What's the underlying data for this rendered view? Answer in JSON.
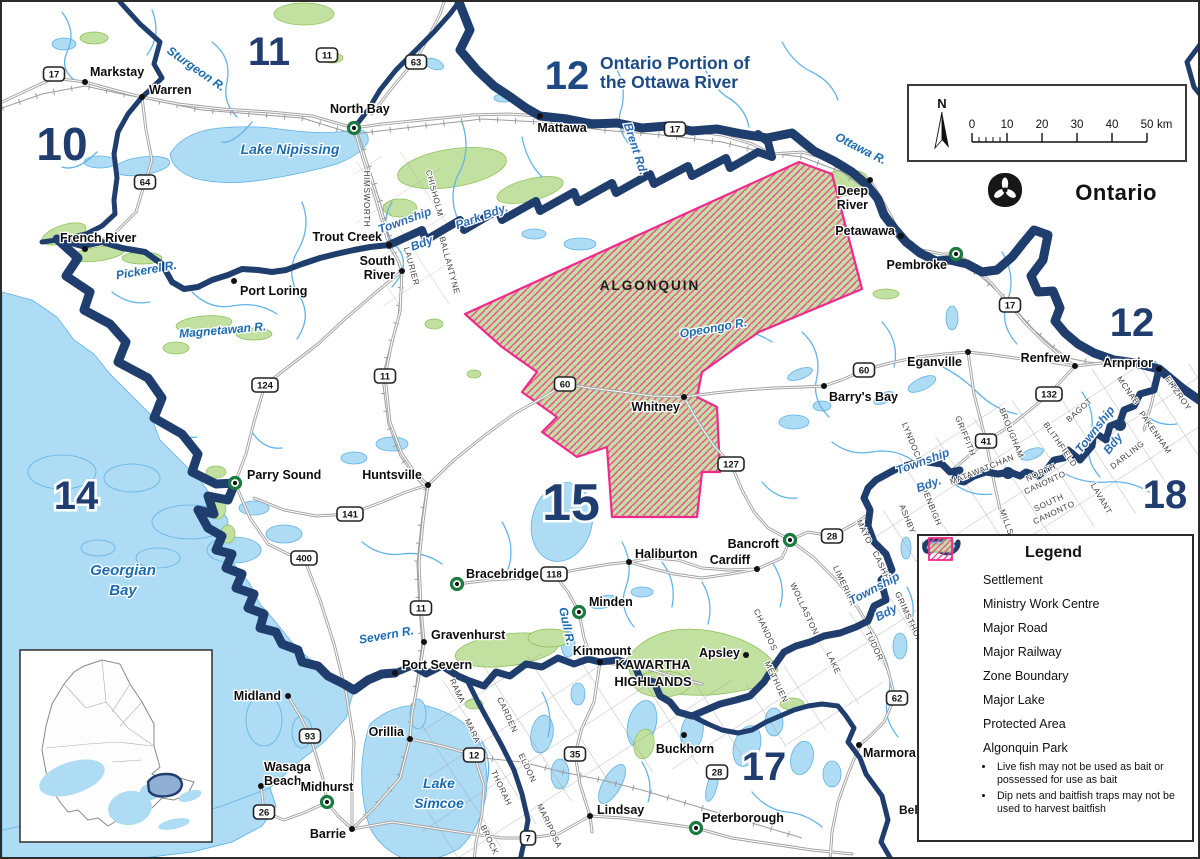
{
  "title": {
    "zone": "12",
    "line1": "Ontario Portion of",
    "line2": "the Ottawa River"
  },
  "logo": {
    "name": "Ontario"
  },
  "scalebar": {
    "north": "N",
    "ticks": [
      "0",
      "10",
      "20",
      "30",
      "40",
      "50"
    ],
    "unit": "km"
  },
  "park_label": {
    "text": "ALGONQUIN",
    "x": 648,
    "y": 288
  },
  "area_labels": [
    {
      "t": "KAWARTHA",
      "x": 651,
      "y": 667,
      "s": 13
    },
    {
      "t": "HIGHLANDS",
      "x": 651,
      "y": 684,
      "s": 13
    },
    {
      "t": "Bell",
      "x": 897,
      "y": 812,
      "s": 12
    }
  ],
  "zones": [
    {
      "t": "10",
      "x": 60,
      "y": 158,
      "s": 46
    },
    {
      "t": "11",
      "x": 267,
      "y": 63,
      "s": 40
    },
    {
      "t": "12",
      "x": 1130,
      "y": 334,
      "s": 40
    },
    {
      "t": "14",
      "x": 74,
      "y": 507,
      "s": 40
    },
    {
      "t": "15",
      "x": 569,
      "y": 518,
      "s": 52
    },
    {
      "t": "17",
      "x": 762,
      "y": 778,
      "s": 40
    },
    {
      "t": "18",
      "x": 1163,
      "y": 506,
      "s": 40
    }
  ],
  "settlements": [
    {
      "n": "Markstay",
      "t": "d",
      "x": 83,
      "y": 80,
      "l": [
        {
          "t": "Markstay",
          "x": 88,
          "y": 74,
          "a": "s"
        }
      ]
    },
    {
      "n": "Warren",
      "t": "d",
      "x": 140,
      "y": 95,
      "l": [
        {
          "t": "Warren",
          "x": 147,
          "y": 92,
          "a": "s"
        }
      ]
    },
    {
      "n": "North Bay",
      "t": "m",
      "x": 352,
      "y": 126,
      "l": [
        {
          "t": "North Bay",
          "x": 328,
          "y": 111,
          "a": "s"
        }
      ]
    },
    {
      "n": "Mattawa",
      "t": "d",
      "x": 538,
      "y": 114,
      "l": [
        {
          "t": "Mattawa",
          "x": 560,
          "y": 130,
          "a": "m"
        }
      ]
    },
    {
      "n": "Trout Creek",
      "t": "d",
      "x": 387,
      "y": 243,
      "l": [
        {
          "t": "Trout Creek",
          "x": 380,
          "y": 239,
          "a": "e"
        }
      ]
    },
    {
      "n": "South River",
      "t": "d",
      "x": 400,
      "y": 269,
      "l": [
        {
          "t": "South",
          "x": 393,
          "y": 263,
          "a": "e"
        },
        {
          "t": "River",
          "x": 393,
          "y": 277,
          "a": "e"
        }
      ]
    },
    {
      "n": "French River",
      "t": "d",
      "x": 83,
      "y": 247,
      "l": [
        {
          "t": "French River",
          "x": 58,
          "y": 240,
          "a": "s"
        }
      ]
    },
    {
      "n": "Port Loring",
      "t": "d",
      "x": 232,
      "y": 279,
      "l": [
        {
          "t": "Port Loring",
          "x": 238,
          "y": 293,
          "a": "s"
        }
      ]
    },
    {
      "n": "Parry Sound",
      "t": "m",
      "x": 233,
      "y": 481,
      "l": [
        {
          "t": "Parry Sound",
          "x": 245,
          "y": 477,
          "a": "s"
        }
      ]
    },
    {
      "n": "Huntsville",
      "t": "d",
      "x": 426,
      "y": 483,
      "l": [
        {
          "t": "Huntsville",
          "x": 420,
          "y": 477,
          "a": "e"
        }
      ]
    },
    {
      "n": "Deep River",
      "t": "d",
      "x": 868,
      "y": 178,
      "l": [
        {
          "t": "Deep",
          "x": 866,
          "y": 193,
          "a": "e"
        },
        {
          "t": "River",
          "x": 866,
          "y": 207,
          "a": "e"
        }
      ]
    },
    {
      "n": "Petawawa",
      "t": "d",
      "x": 899,
      "y": 234,
      "l": [
        {
          "t": "Petawawa",
          "x": 893,
          "y": 233,
          "a": "e"
        }
      ]
    },
    {
      "n": "Pembroke",
      "t": "m",
      "x": 954,
      "y": 252,
      "l": [
        {
          "t": "Pembroke",
          "x": 945,
          "y": 267,
          "a": "e"
        }
      ]
    },
    {
      "n": "Eganville",
      "t": "d",
      "x": 966,
      "y": 350,
      "l": [
        {
          "t": "Eganville",
          "x": 960,
          "y": 364,
          "a": "e"
        }
      ]
    },
    {
      "n": "Renfrew",
      "t": "d",
      "x": 1073,
      "y": 364,
      "l": [
        {
          "t": "Renfrew",
          "x": 1068,
          "y": 360,
          "a": "e"
        }
      ]
    },
    {
      "n": "Arnprior",
      "t": "d",
      "x": 1157,
      "y": 367,
      "l": [
        {
          "t": "Arnprior",
          "x": 1151,
          "y": 365,
          "a": "e"
        }
      ]
    },
    {
      "n": "Barry's Bay",
      "t": "d",
      "x": 822,
      "y": 384,
      "l": [
        {
          "t": "Barry's Bay",
          "x": 827,
          "y": 399,
          "a": "s"
        }
      ]
    },
    {
      "n": "Whitney",
      "t": "d",
      "x": 682,
      "y": 395,
      "l": [
        {
          "t": "Whitney",
          "x": 678,
          "y": 409,
          "a": "e"
        }
      ]
    },
    {
      "n": "Haliburton",
      "t": "d",
      "x": 627,
      "y": 560,
      "l": [
        {
          "t": "Haliburton",
          "x": 633,
          "y": 556,
          "a": "s"
        }
      ]
    },
    {
      "n": "Cardiff",
      "t": "d",
      "x": 755,
      "y": 567,
      "l": [
        {
          "t": "Cardiff",
          "x": 748,
          "y": 562,
          "a": "e"
        }
      ]
    },
    {
      "n": "Bancroft",
      "t": "m",
      "x": 788,
      "y": 538,
      "l": [
        {
          "t": "Bancroft",
          "x": 777,
          "y": 546,
          "a": "e"
        }
      ]
    },
    {
      "n": "Bracebridge",
      "t": "m",
      "x": 455,
      "y": 582,
      "l": [
        {
          "t": "Bracebridge",
          "x": 464,
          "y": 576,
          "a": "s"
        }
      ]
    },
    {
      "n": "Minden",
      "t": "m",
      "x": 577,
      "y": 610,
      "l": [
        {
          "t": "Minden",
          "x": 587,
          "y": 604,
          "a": "s"
        }
      ]
    },
    {
      "n": "Gravenhurst",
      "t": "d",
      "x": 422,
      "y": 640,
      "l": [
        {
          "t": "Gravenhurst",
          "x": 429,
          "y": 637,
          "a": "s"
        }
      ]
    },
    {
      "n": "Kinmount",
      "t": "d",
      "x": 598,
      "y": 660,
      "l": [
        {
          "t": "Kinmount",
          "x": 600,
          "y": 653,
          "a": "m"
        }
      ]
    },
    {
      "n": "Apsley",
      "t": "d",
      "x": 744,
      "y": 653,
      "l": [
        {
          "t": "Apsley",
          "x": 738,
          "y": 655,
          "a": "e"
        }
      ]
    },
    {
      "n": "Buckhorn",
      "t": "d",
      "x": 682,
      "y": 733,
      "l": [
        {
          "t": "Buckhorn",
          "x": 683,
          "y": 751,
          "a": "m"
        }
      ]
    },
    {
      "n": "Lindsay",
      "t": "d",
      "x": 588,
      "y": 814,
      "l": [
        {
          "t": "Lindsay",
          "x": 595,
          "y": 812,
          "a": "s"
        }
      ]
    },
    {
      "n": "Peterborough",
      "t": "m",
      "x": 694,
      "y": 826,
      "l": [
        {
          "t": "Peterborough",
          "x": 700,
          "y": 820,
          "a": "s"
        }
      ]
    },
    {
      "n": "Marmora",
      "t": "d",
      "x": 857,
      "y": 743,
      "l": [
        {
          "t": "Marmora",
          "x": 861,
          "y": 755,
          "a": "s"
        }
      ]
    },
    {
      "n": "Midland",
      "t": "d",
      "x": 286,
      "y": 694,
      "l": [
        {
          "t": "Midland",
          "x": 279,
          "y": 698,
          "a": "e"
        }
      ]
    },
    {
      "n": "Wasaga Beach",
      "t": "d",
      "x": 259,
      "y": 784,
      "l": [
        {
          "t": "Wasaga",
          "x": 262,
          "y": 769,
          "a": "s"
        },
        {
          "t": "Beach",
          "x": 262,
          "y": 783,
          "a": "s"
        }
      ]
    },
    {
      "n": "Midhurst",
      "t": "m",
      "x": 325,
      "y": 800,
      "l": [
        {
          "t": "Midhurst",
          "x": 325,
          "y": 789,
          "a": "m"
        }
      ]
    },
    {
      "n": "Barrie",
      "t": "d",
      "x": 350,
      "y": 827,
      "l": [
        {
          "t": "Barrie",
          "x": 344,
          "y": 836,
          "a": "e"
        }
      ]
    },
    {
      "n": "Orillia",
      "t": "d",
      "x": 408,
      "y": 737,
      "l": [
        {
          "t": "Orillia",
          "x": 402,
          "y": 734,
          "a": "e"
        }
      ]
    },
    {
      "n": "Port Severn",
      "t": "d",
      "x": 393,
      "y": 671,
      "l": [
        {
          "t": "Port Severn",
          "x": 400,
          "y": 667,
          "a": "s"
        }
      ]
    }
  ],
  "water_labels": [
    {
      "t": "Sturgeon R.",
      "x": 192,
      "y": 70,
      "r": 35,
      "s": 12
    },
    {
      "t": "Lake Nipissing",
      "x": 288,
      "y": 152,
      "r": 0,
      "s": 14
    },
    {
      "t": "Ottawa R.",
      "x": 857,
      "y": 150,
      "r": 27,
      "s": 12
    },
    {
      "t": "Pickerel R.",
      "x": 145,
      "y": 272,
      "r": -10,
      "s": 12
    },
    {
      "t": "Magnetawan R.",
      "x": 221,
      "y": 332,
      "r": -5,
      "s": 12
    },
    {
      "t": "Opeongo R.",
      "x": 712,
      "y": 330,
      "r": -10,
      "s": 12
    },
    {
      "t": "Georgian",
      "x": 121,
      "y": 573,
      "r": 0,
      "s": 15
    },
    {
      "t": "Bay",
      "x": 121,
      "y": 593,
      "r": 0,
      "s": 15
    },
    {
      "t": "Severn R.",
      "x": 385,
      "y": 637,
      "r": -10,
      "s": 12
    },
    {
      "t": "Gull R.",
      "x": 561,
      "y": 625,
      "r": 78,
      "s": 12
    },
    {
      "t": "Lake",
      "x": 437,
      "y": 786,
      "r": 0,
      "s": 14
    },
    {
      "t": "Simcoe",
      "x": 437,
      "y": 806,
      "r": 0,
      "s": 14
    }
  ],
  "boundary_labels": [
    {
      "t": "Township",
      "x": 404,
      "y": 222,
      "r": -20
    },
    {
      "t": "Bdy",
      "x": 421,
      "y": 245,
      "r": -20
    },
    {
      "t": "Park Bdy.",
      "x": 481,
      "y": 218,
      "r": -20
    },
    {
      "t": "Brent Rd.",
      "x": 630,
      "y": 148,
      "r": 72
    },
    {
      "t": "Township",
      "x": 922,
      "y": 463,
      "r": -20
    },
    {
      "t": "Bdy.",
      "x": 928,
      "y": 486,
      "r": -20
    },
    {
      "t": "Township",
      "x": 1096,
      "y": 430,
      "r": -52
    },
    {
      "t": "Bdy",
      "x": 1114,
      "y": 444,
      "r": -52
    },
    {
      "t": "Township",
      "x": 874,
      "y": 590,
      "r": -28
    },
    {
      "t": "Bdy",
      "x": 886,
      "y": 614,
      "r": -28
    }
  ],
  "townships": [
    {
      "t": "HIMSWORTH",
      "x": 362,
      "y": 197,
      "r": 90
    },
    {
      "t": "CHISHOLM",
      "x": 430,
      "y": 192,
      "r": 75
    },
    {
      "t": "LAURIER",
      "x": 407,
      "y": 265,
      "r": 75
    },
    {
      "t": "BALLANTYNE",
      "x": 445,
      "y": 264,
      "r": 75
    },
    {
      "t": "LYNDOCH",
      "x": 908,
      "y": 442,
      "r": 68
    },
    {
      "t": "DENBIGH",
      "x": 927,
      "y": 505,
      "r": 68
    },
    {
      "t": "ASHBY",
      "x": 903,
      "y": 518,
      "r": 68
    },
    {
      "t": "GRIFFITH",
      "x": 961,
      "y": 435,
      "r": 68
    },
    {
      "t": "BROUGHAM",
      "x": 1007,
      "y": 432,
      "r": 68
    },
    {
      "t": "BAGOT",
      "x": 1079,
      "y": 410,
      "r": -42
    },
    {
      "t": "BLITHFIELD",
      "x": 1056,
      "y": 444,
      "r": 55
    },
    {
      "t": "MATAWATCHAN",
      "x": 981,
      "y": 470,
      "r": -22
    },
    {
      "t": "NORTH",
      "x": 1040,
      "y": 473,
      "r": -25
    },
    {
      "t": "CANONTO",
      "x": 1044,
      "y": 483,
      "r": -25
    },
    {
      "t": "SOUTH",
      "x": 1048,
      "y": 503,
      "r": -25
    },
    {
      "t": "CANONTO",
      "x": 1053,
      "y": 513,
      "r": -25
    },
    {
      "t": "MILLS",
      "x": 1002,
      "y": 521,
      "r": 70
    },
    {
      "t": "LAVANT",
      "x": 1097,
      "y": 498,
      "r": 60
    },
    {
      "t": "DARLING",
      "x": 1127,
      "y": 455,
      "r": -38
    },
    {
      "t": "PAKENHAM",
      "x": 1151,
      "y": 432,
      "r": 55
    },
    {
      "t": "MCNAB",
      "x": 1124,
      "y": 390,
      "r": 55
    },
    {
      "t": "FITZROY",
      "x": 1174,
      "y": 393,
      "r": 55
    },
    {
      "t": "MAYO",
      "x": 860,
      "y": 531,
      "r": 65
    },
    {
      "t": "CASHEL",
      "x": 878,
      "y": 567,
      "r": 65
    },
    {
      "t": "LIMERICK",
      "x": 840,
      "y": 585,
      "r": 65
    },
    {
      "t": "GRIMSTHORPE",
      "x": 907,
      "y": 622,
      "r": 65
    },
    {
      "t": "TUDOR",
      "x": 870,
      "y": 645,
      "r": 65
    },
    {
      "t": "WOLLASTON",
      "x": 800,
      "y": 608,
      "r": 65
    },
    {
      "t": "CHANDOS",
      "x": 761,
      "y": 629,
      "r": 65
    },
    {
      "t": "METHUEN",
      "x": 772,
      "y": 681,
      "r": 65
    },
    {
      "t": "LAKE",
      "x": 829,
      "y": 662,
      "r": 65
    },
    {
      "t": "RAMA",
      "x": 453,
      "y": 690,
      "r": 65
    },
    {
      "t": "MARA",
      "x": 468,
      "y": 730,
      "r": 65
    },
    {
      "t": "CARDEN",
      "x": 503,
      "y": 714,
      "r": 65
    },
    {
      "t": "ELDON",
      "x": 523,
      "y": 767,
      "r": 65
    },
    {
      "t": "THORAH",
      "x": 497,
      "y": 787,
      "r": 65
    },
    {
      "t": "MARIPOSA",
      "x": 545,
      "y": 825,
      "r": 65
    },
    {
      "t": "BROCK",
      "x": 485,
      "y": 839,
      "r": 65
    }
  ],
  "shields": [
    {
      "t": "17",
      "x": 52,
      "y": 72
    },
    {
      "t": "17",
      "x": 673,
      "y": 127
    },
    {
      "t": "17",
      "x": 1008,
      "y": 303
    },
    {
      "t": "11",
      "x": 325,
      "y": 53
    },
    {
      "t": "11",
      "x": 383,
      "y": 374
    },
    {
      "t": "11",
      "x": 419,
      "y": 606
    },
    {
      "t": "63",
      "x": 414,
      "y": 60
    },
    {
      "t": "64",
      "x": 143,
      "y": 180
    },
    {
      "t": "124",
      "x": 263,
      "y": 383
    },
    {
      "t": "141",
      "x": 348,
      "y": 512
    },
    {
      "t": "400",
      "x": 302,
      "y": 556
    },
    {
      "t": "60",
      "x": 563,
      "y": 382
    },
    {
      "t": "60",
      "x": 862,
      "y": 368
    },
    {
      "t": "127",
      "x": 729,
      "y": 462
    },
    {
      "t": "118",
      "x": 552,
      "y": 572
    },
    {
      "t": "35",
      "x": 573,
      "y": 752
    },
    {
      "t": "28",
      "x": 830,
      "y": 534
    },
    {
      "t": "28",
      "x": 715,
      "y": 770
    },
    {
      "t": "62",
      "x": 895,
      "y": 696
    },
    {
      "t": "132",
      "x": 1047,
      "y": 392
    },
    {
      "t": "41",
      "x": 984,
      "y": 439
    },
    {
      "t": "93",
      "x": 308,
      "y": 734
    },
    {
      "t": "26",
      "x": 262,
      "y": 810
    },
    {
      "t": "12",
      "x": 472,
      "y": 753
    },
    {
      "t": "7",
      "x": 526,
      "y": 836
    }
  ],
  "legend": {
    "title": "Legend",
    "items": [
      {
        "sym": "dot",
        "label": "Settlement"
      },
      {
        "sym": "mwc",
        "label": "Ministry Work Centre"
      },
      {
        "sym": "road",
        "label": "Major Road"
      },
      {
        "sym": "rail",
        "label": "Major Railway"
      },
      {
        "sym": "zone",
        "label": "Zone Boundary"
      },
      {
        "sym": "lake",
        "label": "Major Lake"
      },
      {
        "sym": "protected",
        "label": "Protected Area"
      },
      {
        "sym": "park",
        "label": "Algonquin Park"
      }
    ],
    "park_notes": [
      "Live fish may not be used as bait or possessed for use as bait",
      "Dip nets and baitfish traps may not be used to harvest baitfish"
    ]
  },
  "colors": {
    "navy": "#1f3e6d",
    "title_blue": "#1d4a85",
    "water": "#aedcf5",
    "water_line": "#5fb2e5",
    "green": "#c2e09f",
    "pink": "#ee2a8c",
    "road": "#a3a3a3",
    "label_blue": "#1a6bb0",
    "bdy_blue": "#2b6cb5",
    "mwc_green": "#1c7a40"
  }
}
